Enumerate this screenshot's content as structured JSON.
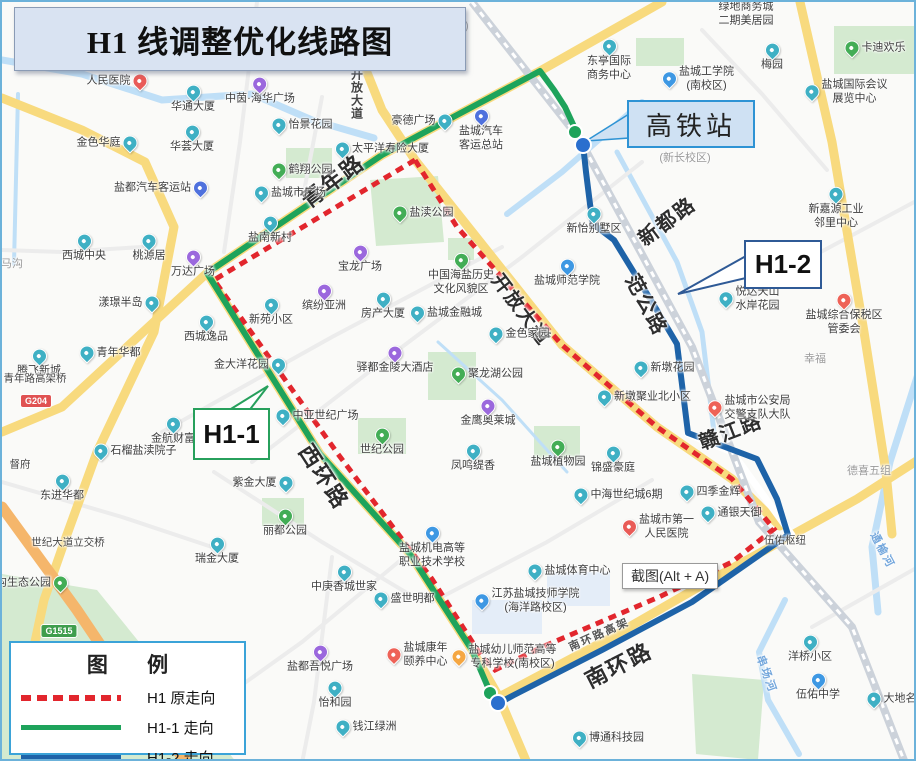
{
  "title": {
    "text": "H1 线调整优化线路图"
  },
  "tooltip": {
    "text": "截图(Alt + A)"
  },
  "callouts": {
    "hsr": {
      "label": "高铁站"
    },
    "h11": {
      "label": "H1-1"
    },
    "h12": {
      "label": "H1-2"
    }
  },
  "legend": {
    "title": "图 例",
    "items": [
      {
        "label": "H1 原走向",
        "type": "red-dash",
        "color": "#e2262d"
      },
      {
        "label": "H1-1 走向",
        "type": "solid",
        "color": "#1ea35b"
      },
      {
        "label": "H1-2 走向",
        "type": "solid",
        "color": "#1e63a8"
      }
    ]
  },
  "colors": {
    "building": "#3fb0c4",
    "bus": "#4f71dd",
    "shopping": "#9b68dd",
    "park": "#43ad56",
    "school": "#3e98e3",
    "hospital": "#e95b57",
    "star": "#ee6257",
    "orange": "#f5a742",
    "route_original": "#e2262d",
    "route_h11": "#1ea35b",
    "route_h12": "#1e63a8"
  },
  "shields": [
    {
      "text": "G204",
      "x": 34,
      "y": 399,
      "bg": "#e05252"
    },
    {
      "text": "G1515",
      "x": 57,
      "y": 629,
      "bg": "#3f9e4d"
    }
  ],
  "roadLabels": [
    {
      "text": "青年路",
      "x": 330,
      "y": 178,
      "rot": -37,
      "size": 22
    },
    {
      "text": "新都路",
      "x": 664,
      "y": 218,
      "rot": -37,
      "size": 20
    },
    {
      "text": "范公路",
      "x": 646,
      "y": 302,
      "rot": 62,
      "size": 20
    },
    {
      "text": "赣江路",
      "x": 728,
      "y": 428,
      "rot": -21,
      "size": 20
    },
    {
      "text": "西环路",
      "x": 323,
      "y": 474,
      "rot": 57,
      "size": 22
    },
    {
      "text": "南环路",
      "x": 616,
      "y": 662,
      "rot": -27,
      "size": 22
    },
    {
      "text": "南环路高架",
      "x": 597,
      "y": 632,
      "rot": -24,
      "size": 11,
      "color": "#555"
    },
    {
      "text": "开放大道",
      "x": 520,
      "y": 307,
      "rot": 53,
      "size": 19
    },
    {
      "text": "开放大道",
      "x": 355,
      "y": 92,
      "rot": 0,
      "size": 12,
      "color": "#444",
      "vert": true
    },
    {
      "text": "串场河",
      "x": 765,
      "y": 672,
      "rot": 70,
      "size": 11,
      "color": "#74a7dc"
    },
    {
      "text": "通榆河",
      "x": 881,
      "y": 548,
      "rot": 62,
      "size": 11,
      "color": "#74a7dc"
    }
  ],
  "pois": [
    {
      "t": "绿地商务城\n二期美居园",
      "x": 744,
      "y": 12,
      "ic": null,
      "ip": "top"
    },
    {
      "t": "东亭国际\n商务中心",
      "x": 607,
      "y": 58,
      "ic": "building",
      "ip": "top"
    },
    {
      "t": "盐城工学院\n(南校区)",
      "x": 695,
      "y": 77,
      "ic": "school",
      "ip": "il"
    },
    {
      "t": "梅园",
      "x": 770,
      "y": 55,
      "ic": "building",
      "ip": "top"
    },
    {
      "t": "卡迪欢乐",
      "x": 872,
      "y": 46,
      "ic": "park",
      "ip": "il"
    },
    {
      "t": "盐城国际会议\n展览中心",
      "x": 843,
      "y": 90,
      "ic": "building",
      "ip": "il"
    },
    {
      "t": "(新长校区)",
      "x": 683,
      "y": 157,
      "ic": null,
      "ip": "top",
      "cls": "dim"
    },
    {
      "t": "(通榆校区)",
      "x": 441,
      "y": 25,
      "ic": null,
      "ip": "top",
      "cls": "dim"
    },
    {
      "t": "人民医院",
      "x": 116,
      "y": 79,
      "ic": "hospital",
      "ip": "ir"
    },
    {
      "t": "华通大厦",
      "x": 191,
      "y": 97,
      "ic": "building",
      "ip": "top"
    },
    {
      "t": "中茵·海华广场",
      "x": 258,
      "y": 89,
      "ic": "shopping",
      "ip": "top"
    },
    {
      "t": "怡景花园",
      "x": 299,
      "y": 123,
      "ic": "building",
      "ip": "il"
    },
    {
      "t": "金色华庭",
      "x": 106,
      "y": 141,
      "ic": "building",
      "ip": "ir"
    },
    {
      "t": "华荟大厦",
      "x": 190,
      "y": 137,
      "ic": "building",
      "ip": "top"
    },
    {
      "t": "太平洋寿险大厦",
      "x": 379,
      "y": 147,
      "ic": "building",
      "ip": "il"
    },
    {
      "t": "豪德广场",
      "x": 421,
      "y": 119,
      "ic": "building",
      "ip": "ir"
    },
    {
      "t": "盐城汽车\n客运总站",
      "x": 479,
      "y": 128,
      "ic": "bus",
      "ip": "top"
    },
    {
      "t": "鹤翔公园",
      "x": 299,
      "y": 168,
      "ic": "park",
      "ip": "il"
    },
    {
      "t": "盐都汽车客运站",
      "x": 160,
      "y": 186,
      "ic": "bus",
      "ip": "ir"
    },
    {
      "t": "盐城市广场",
      "x": 287,
      "y": 191,
      "ic": "building",
      "ip": "il"
    },
    {
      "t": "盐南新村",
      "x": 268,
      "y": 228,
      "ic": "building",
      "ip": "top"
    },
    {
      "t": "新怡别墅区",
      "x": 592,
      "y": 219,
      "ic": "building",
      "ip": "top"
    },
    {
      "t": "新嘉源工业\n邻里中心",
      "x": 834,
      "y": 206,
      "ic": "building",
      "ip": "top"
    },
    {
      "t": "西城中央",
      "x": 82,
      "y": 246,
      "ic": "building",
      "ip": "top"
    },
    {
      "t": "桃源居",
      "x": 147,
      "y": 246,
      "ic": "building",
      "ip": "top"
    },
    {
      "t": "万达广场",
      "x": 191,
      "y": 262,
      "ic": "shopping",
      "ip": "top"
    },
    {
      "t": "盐渎公园",
      "x": 420,
      "y": 211,
      "ic": "park",
      "ip": "il"
    },
    {
      "t": "宝龙广场",
      "x": 358,
      "y": 257,
      "ic": "shopping",
      "ip": "top"
    },
    {
      "t": "中国海盐历史\n文化风貌区",
      "x": 459,
      "y": 272,
      "ic": "park",
      "ip": "top"
    },
    {
      "t": "盐城师范学院",
      "x": 565,
      "y": 271,
      "ic": "school",
      "ip": "top"
    },
    {
      "t": "悦达天山\n水岸花园",
      "x": 746,
      "y": 297,
      "ic": "building",
      "ip": "il"
    },
    {
      "t": "盐城综合保税区\n管委会",
      "x": 842,
      "y": 312,
      "ic": "star",
      "ip": "top"
    },
    {
      "t": "幸福",
      "x": 813,
      "y": 358,
      "ic": null,
      "ip": "top",
      "cls": "dim"
    },
    {
      "t": "漾璟半岛",
      "x": 128,
      "y": 301,
      "ic": "building",
      "ip": "ir"
    },
    {
      "t": "新苑小区",
      "x": 269,
      "y": 310,
      "ic": "building",
      "ip": "top"
    },
    {
      "t": "缤纷亚洲",
      "x": 322,
      "y": 296,
      "ic": "shopping",
      "ip": "top"
    },
    {
      "t": "房产大厦",
      "x": 381,
      "y": 304,
      "ic": "building",
      "ip": "top"
    },
    {
      "t": "盐城金融城",
      "x": 443,
      "y": 311,
      "ic": "building",
      "ip": "il"
    },
    {
      "t": "西城逸品",
      "x": 204,
      "y": 327,
      "ic": "building",
      "ip": "top"
    },
    {
      "t": "青年华都",
      "x": 107,
      "y": 351,
      "ic": "building",
      "ip": "il"
    },
    {
      "t": "腾飞新城",
      "x": 37,
      "y": 361,
      "ic": "building",
      "ip": "top"
    },
    {
      "t": "金大洋花园",
      "x": 249,
      "y": 363,
      "ic": "building",
      "ip": "ir"
    },
    {
      "t": "驿都金陵大酒店",
      "x": 393,
      "y": 358,
      "ic": "shopping",
      "ip": "top"
    },
    {
      "t": "金航财富",
      "x": 171,
      "y": 429,
      "ic": "building",
      "ip": "top"
    },
    {
      "t": "石榴盐渎院子",
      "x": 132,
      "y": 449,
      "ic": "building",
      "ip": "il"
    },
    {
      "t": "中亚世纪广场",
      "x": 314,
      "y": 414,
      "ic": "building",
      "ip": "il"
    },
    {
      "t": "世纪公园",
      "x": 380,
      "y": 440,
      "ic": "park",
      "ip": "top"
    },
    {
      "t": "金色家园",
      "x": 516,
      "y": 332,
      "ic": "building",
      "ip": "il"
    },
    {
      "t": "聚龙湖公园",
      "x": 484,
      "y": 372,
      "ic": "park",
      "ip": "il"
    },
    {
      "t": "金鹰奥莱城",
      "x": 486,
      "y": 411,
      "ic": "shopping",
      "ip": "top"
    },
    {
      "t": "新墩花园",
      "x": 661,
      "y": 366,
      "ic": "building",
      "ip": "il"
    },
    {
      "t": "新墩聚业北小区",
      "x": 641,
      "y": 395,
      "ic": "building",
      "ip": "il"
    },
    {
      "t": "盐城市公安局\n交警支队大队",
      "x": 746,
      "y": 406,
      "ic": "star",
      "ip": "il"
    },
    {
      "t": "凤鸣缇香",
      "x": 471,
      "y": 456,
      "ic": "building",
      "ip": "top"
    },
    {
      "t": "盐城植物园",
      "x": 556,
      "y": 452,
      "ic": "park",
      "ip": "top"
    },
    {
      "t": "锦盛豪庭",
      "x": 611,
      "y": 458,
      "ic": "building",
      "ip": "top"
    },
    {
      "t": "四季金辉",
      "x": 707,
      "y": 490,
      "ic": "building",
      "ip": "il"
    },
    {
      "t": "通银天御",
      "x": 728,
      "y": 511,
      "ic": "building",
      "ip": "il"
    },
    {
      "t": "中海世纪城6期",
      "x": 615,
      "y": 493,
      "ic": "building",
      "ip": "il"
    },
    {
      "t": "盐城市第一\n人民医院",
      "x": 655,
      "y": 525,
      "ic": "hospital",
      "ip": "il"
    },
    {
      "t": "伍佑枢纽",
      "x": 783,
      "y": 539,
      "ic": null,
      "ip": "top",
      "cls": "plain"
    },
    {
      "t": "德喜五组",
      "x": 867,
      "y": 470,
      "ic": null,
      "ip": "top",
      "cls": "dim"
    },
    {
      "t": "洋桥小区",
      "x": 808,
      "y": 647,
      "ic": "building",
      "ip": "top"
    },
    {
      "t": "伍佑中学",
      "x": 816,
      "y": 685,
      "ic": "school",
      "ip": "top"
    },
    {
      "t": "大地名城",
      "x": 894,
      "y": 697,
      "ic": "building",
      "ip": "il"
    },
    {
      "t": "博通科技园",
      "x": 605,
      "y": 736,
      "ic": "building",
      "ip": "il"
    },
    {
      "t": "钱江绿洲",
      "x": 363,
      "y": 725,
      "ic": "building",
      "ip": "il"
    },
    {
      "t": "怡和园",
      "x": 333,
      "y": 693,
      "ic": "building",
      "ip": "top"
    },
    {
      "t": "盐都吾悦广场",
      "x": 318,
      "y": 657,
      "ic": "shopping",
      "ip": "top"
    },
    {
      "t": "盐城康年\n颐养中心",
      "x": 414,
      "y": 653,
      "ic": "star",
      "ip": "il"
    },
    {
      "t": "盛世明都",
      "x": 401,
      "y": 597,
      "ic": "building",
      "ip": "il"
    },
    {
      "t": "中庚香城世家",
      "x": 342,
      "y": 577,
      "ic": "building",
      "ip": "top"
    },
    {
      "t": "盐城机电高等\n职业技术学校",
      "x": 430,
      "y": 545,
      "ic": "school",
      "ip": "top"
    },
    {
      "t": "盐城体育中心",
      "x": 566,
      "y": 569,
      "ic": "building",
      "ip": "il"
    },
    {
      "t": "江苏盐城技师学院\n(海洋路校区)",
      "x": 524,
      "y": 599,
      "ic": "school",
      "ip": "il"
    },
    {
      "t": "盐城幼儿师范高等\n专科学校(南校区)",
      "x": 501,
      "y": 655,
      "ic": "orange",
      "ip": "il"
    },
    {
      "t": "紫金大厦",
      "x": 262,
      "y": 481,
      "ic": "building",
      "ip": "ir"
    },
    {
      "t": "丽都公园",
      "x": 283,
      "y": 521,
      "ic": "park",
      "ip": "top"
    },
    {
      "t": "瑞金大厦",
      "x": 215,
      "y": 549,
      "ic": "building",
      "ip": "top"
    },
    {
      "t": "世纪大道立交桥",
      "x": 66,
      "y": 541,
      "ic": null,
      "ip": "top",
      "cls": "plain"
    },
    {
      "t": "东进华都",
      "x": 60,
      "y": 486,
      "ic": "building",
      "ip": "top"
    },
    {
      "t": "督府",
      "x": 18,
      "y": 463,
      "ic": null,
      "ip": "top",
      "cls": "plain"
    },
    {
      "t": "沟生态公园",
      "x": 31,
      "y": 581,
      "ic": "park",
      "ip": "ir"
    },
    {
      "t": "马沟",
      "x": 10,
      "y": 263,
      "ic": null,
      "ip": "top",
      "cls": "dim"
    },
    {
      "t": "青年路高架桥",
      "x": 33,
      "y": 377,
      "ic": null,
      "ip": "top",
      "cls": "plain"
    }
  ],
  "map": {
    "layers": [
      {
        "cls": "park",
        "poly": true,
        "pts": "368,178 436,174 442,240 374,244"
      },
      {
        "cls": "park",
        "poly": true,
        "pts": "284,146 330,146 330,176 284,176"
      },
      {
        "cls": "park",
        "poly": true,
        "pts": "426,350 474,350 474,398 426,398"
      },
      {
        "cls": "park",
        "poly": true,
        "pts": "356,416 404,416 404,452 356,452"
      },
      {
        "cls": "park",
        "poly": true,
        "pts": "260,496 302,496 302,524 260,524"
      },
      {
        "cls": "park",
        "poly": true,
        "pts": "0,572 95,588 235,761 0,761"
      },
      {
        "cls": "park",
        "poly": true,
        "pts": "690,672 762,678 756,758 694,752"
      },
      {
        "cls": "park",
        "poly": true,
        "pts": "532,424 578,424 578,458 532,458"
      },
      {
        "cls": "park",
        "poly": true,
        "pts": "832,24 914,24 914,72 832,72"
      },
      {
        "cls": "park",
        "poly": true,
        "pts": "634,36 682,36 682,64 634,64"
      },
      {
        "cls": "park",
        "poly": true,
        "pts": "446,236 472,236 472,258 446,258"
      },
      {
        "cls": "block",
        "poly": true,
        "pts": "545,570 608,570 608,604 545,604"
      },
      {
        "cls": "block",
        "poly": true,
        "pts": "470,598 540,598 540,632 470,632"
      },
      {
        "cls": "water",
        "w": 7,
        "pts": "0,58 80,72 160,98 250,92 310,118 372,136"
      },
      {
        "cls": "water",
        "w": 6,
        "pts": "640,100 560,170 505,212"
      },
      {
        "cls": "water",
        "w": 7,
        "pts": "916,372 888,460 870,545 876,610"
      },
      {
        "cls": "water",
        "w": 6,
        "pts": "783,598 757,650 766,698 797,752"
      },
      {
        "cls": "water",
        "w": 4,
        "pts": "16,92 12,262"
      },
      {
        "cls": "water",
        "w": 3,
        "pts": "436,340 500,398 545,448 565,470"
      },
      {
        "cls": "water",
        "w": 5,
        "pts": "615,150 675,260 700,330 712,430"
      },
      {
        "cls": "minor",
        "pts": "255,0 238,140 222,250"
      },
      {
        "cls": "minor",
        "pts": "500,245 330,335 160,430"
      },
      {
        "cls": "minor",
        "pts": "640,160 520,255 380,360 250,460"
      },
      {
        "cls": "minor",
        "pts": "700,28 760,92 825,168"
      },
      {
        "cls": "minor",
        "pts": "916,198 800,260 740,300"
      },
      {
        "cls": "minor",
        "pts": "212,470 320,540 420,600"
      },
      {
        "cls": "minor",
        "pts": "0,480 120,515 210,545"
      },
      {
        "cls": "minor",
        "pts": "650,478 545,540 430,600"
      },
      {
        "cls": "minor",
        "pts": "330,555 312,700 300,761"
      },
      {
        "cls": "minor",
        "pts": "810,625 916,565"
      },
      {
        "cls": "minor",
        "pts": "320,95 300,200"
      },
      {
        "cls": "minor",
        "pts": "140,245 60,250 0,248"
      },
      {
        "cls": "minor",
        "pts": "406,552 300,640 230,690"
      },
      {
        "cls": "yellow",
        "pts": "660,0 538,69 380,153 205,271 60,405 0,430"
      },
      {
        "cls": "yellow",
        "pts": "205,271 318,452 408,552 470,648 497,695 525,761"
      },
      {
        "cls": "yellow",
        "pts": "497,695 610,635 700,583 790,533 855,497 916,458"
      },
      {
        "cls": "yellow",
        "pts": "348,28 380,108 413,158 560,343 655,425 730,477 778,524"
      },
      {
        "cls": "yellow",
        "pts": "0,96 80,128 143,160 172,225 152,330 95,450 63,538 42,598 20,700"
      },
      {
        "cls": "yellow",
        "pts": "798,0 830,140 862,330 884,470 890,532"
      },
      {
        "cls": "whiteroad",
        "pts": "686,432 730,450 790,533"
      },
      {
        "cls": "orange",
        "pts": "0,505 75,608 130,690 185,761"
      },
      {
        "cls": "railbed",
        "pts": "470,0 577,136 690,345 757,520 850,625 903,761"
      },
      {
        "cls": "railtie",
        "pts": "470,0 577,136 690,345 757,520 850,625 903,761"
      }
    ]
  },
  "routes": {
    "original": {
      "name": "H1 原走向",
      "cls": "route-red",
      "pts": "413,158 212,278 336,452 430,577 480,655 493,668 540,645 657,595 730,560 772,527 730,477 655,425 560,343 455,225 413,158"
    },
    "h11": {
      "name": "H1-1 走向",
      "cls": "route-green",
      "pts": "575,131 563,105 552,88 538,69 455,113 380,153 205,271 318,452 408,552 470,648 488,690"
    },
    "h12": {
      "name": "H1-2 走向",
      "cls": "route-blue",
      "pts": "581,142 584,170 588,202 591,222 612,238 650,300 675,342 686,431 755,457 775,497 786,533 690,600 600,648 512,693 497,701"
    },
    "dots": [
      {
        "x": 573,
        "y": 130,
        "r": 7,
        "c": "#1ea35b"
      },
      {
        "x": 488,
        "y": 691,
        "r": 7,
        "c": "#1ea35b"
      },
      {
        "x": 581,
        "y": 143,
        "r": 8,
        "c": "#2a6fce"
      },
      {
        "x": 496,
        "y": 701,
        "r": 8,
        "c": "#2a6fce"
      }
    ],
    "pointers": [
      {
        "cls": "ptr-hsr",
        "pts": "627,112 584,139 627,136"
      },
      {
        "cls": "ptr-h11",
        "pts": "224,410 266,384 246,410"
      },
      {
        "cls": "ptr-h12",
        "pts": "744,254 676,292 744,276"
      }
    ]
  }
}
